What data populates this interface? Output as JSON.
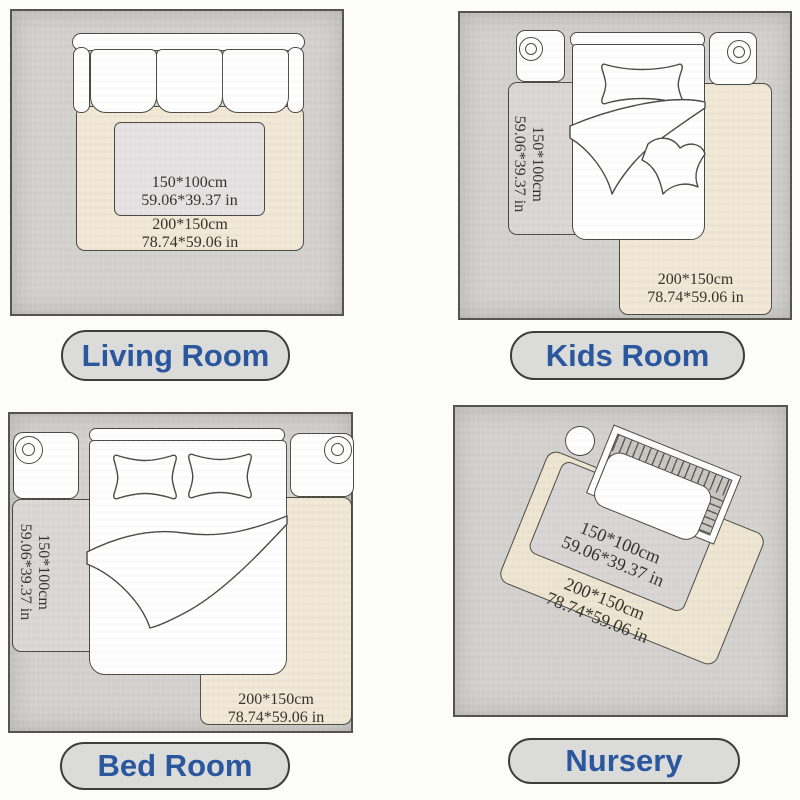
{
  "palette": {
    "page_bg": "#fcfcfa",
    "room_bg": "#d3d2ce",
    "rug_beige": "#f1e8d6",
    "rug_gray": "#dbd7d5",
    "rug_pink": "#e6e2e3",
    "outline": "#4a4942",
    "pill_bg": "#dbdbd9",
    "pill_border": "#3e3e39",
    "pill_text": "#2a579e",
    "dimension_text": "#33312c"
  },
  "sizes": {
    "small": {
      "cm": "150*100cm",
      "inch": "59.06*39.37 in"
    },
    "large": {
      "cm": "200*150cm",
      "inch": "78.74*59.06 in"
    }
  },
  "rooms": [
    {
      "label": "Living Room"
    },
    {
      "label": "Kids Room"
    },
    {
      "label": "Bed Room"
    },
    {
      "label": "Nursery"
    }
  ]
}
